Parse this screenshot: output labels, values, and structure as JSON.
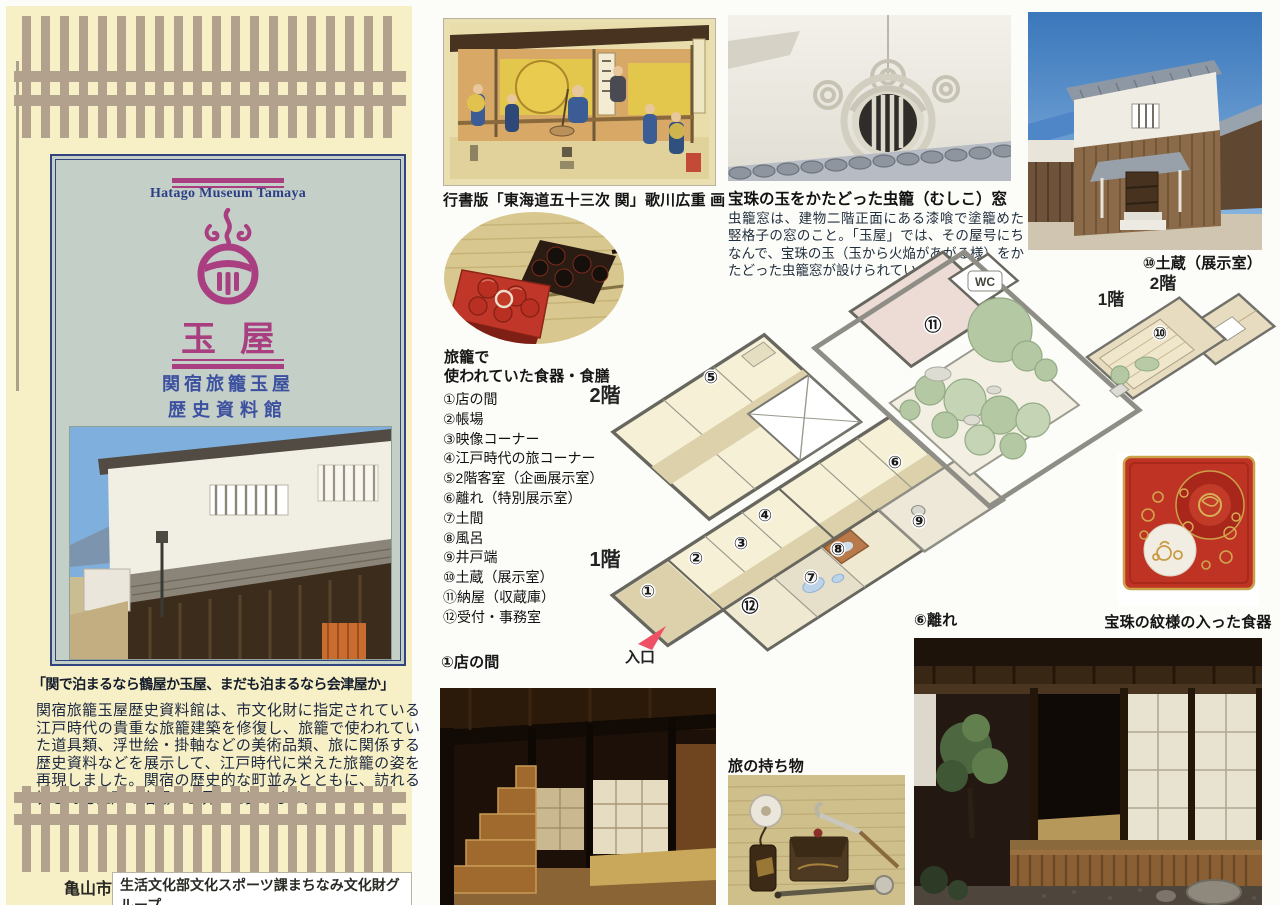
{
  "colors": {
    "panel_bg": "#f7efc6",
    "stripe": "#b2a28d",
    "card_bg": "#c4cfc8",
    "navy": "#2f4190",
    "magenta": "#a93f80",
    "text_dark": "#1c2940"
  },
  "left_panel": {
    "museum_name_en": "Hatago Museum Tamaya",
    "logo_icon": "treasure-jewel-flame",
    "title": "玉屋",
    "subtitle_line1": "関宿旅籠玉屋",
    "subtitle_line2": "歴史資料館",
    "quote": "「関で泊まるなら鶴屋か玉屋、まだも泊まるなら会津屋か」",
    "description": "関宿旅籠玉屋歴史資料館は、市文化財に指定されている江戸時代の貴重な旅籠建築を修復し、旅籠で使われていた道具類、浮世絵・掛軸などの美術品類、旅に関係する歴史資料などを展示して、江戸時代に栄えた旅籠の姿を再現しました。関宿の歴史的な町並みとともに、訪れる皆さんを江戸の宿場の世界へと誘います。",
    "footer_city": "亀山市",
    "footer_dept": "生活文化部文化スポーツ課まちなみ文化財グループ"
  },
  "sections": {
    "ukiyoe_caption": "行書版「東海道五十三次 関」歌川広重 画",
    "mushiko_heading": "宝珠の玉をかたどった虫籠（むしこ）窓",
    "mushiko_body": "虫籠窓は、建物二階正面にある漆喰で塗籠めた竪格子の窓のこと。「玉屋」では、その屋号にちなんで、宝珠の玉（玉から火焔があがる様）をかたどった虫籠窓が設けられています。",
    "kura_caption": "⑩土蔵（展示室）",
    "tray_caption_line1": "旅籠で",
    "tray_caption_line2": "使われていた食器・食膳",
    "jewel_tray_caption": "宝珠の紋様の入った食器",
    "misenoma_caption": "①店の間",
    "belongings_caption": "旅の持ち物",
    "hanare_caption": "⑥離れ"
  },
  "room_list": [
    {
      "label": "①店の間"
    },
    {
      "label": "②帳場"
    },
    {
      "label": "③映像コーナー"
    },
    {
      "label": "④江戸時代の旅コーナー"
    },
    {
      "label": "⑤2階客室（企画展示室）"
    },
    {
      "label": "⑥離れ（特別展示室）"
    },
    {
      "label": "⑦土間"
    },
    {
      "label": "⑧風呂"
    },
    {
      "label": "⑨井戸端"
    },
    {
      "label": "⑩土蔵（展示室）"
    },
    {
      "label": "⑪納屋（収蔵庫）"
    },
    {
      "label": "⑫受付・事務室"
    }
  ],
  "floorplan": {
    "floor2_label": "2階",
    "floor1_label": "1階",
    "kura_floor2_label": "2階",
    "kura_floor1_label": "1階",
    "entrance_label": "入口",
    "wc_label": "WC",
    "marks": {
      "m1": "①",
      "m2": "②",
      "m3": "③",
      "m4": "④",
      "m5": "⑤",
      "m6": "⑥",
      "m7": "⑦",
      "m8": "⑧",
      "m9": "⑨",
      "m10": "⑩",
      "m11": "⑪",
      "m12": "⑫"
    }
  }
}
